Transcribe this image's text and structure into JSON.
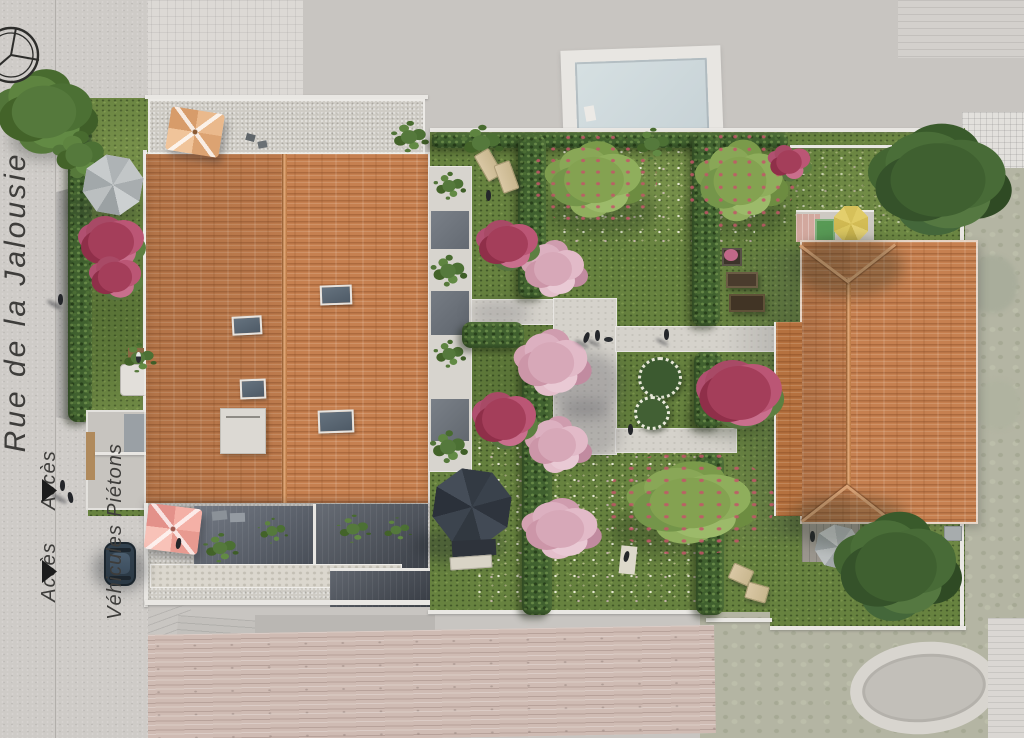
{
  "street": {
    "name": "Rue de la Jalousie",
    "access": [
      {
        "type": "pedestrian",
        "label_line1": "Accès",
        "label_line2": "Piétons",
        "arrow_icon": "right-triangle-arrow"
      },
      {
        "type": "vehicle",
        "label_line1": "Accès",
        "label_line2": "Véhicules",
        "arrow_icon": "right-triangle-arrow"
      }
    ]
  },
  "icons": {
    "compass": "compass-rose-icon"
  },
  "palette": {
    "surroundings_desaturated": "#c8c5c1",
    "street_gray": "#cecbc7",
    "lawn_green": "#67823f",
    "path_gray": "#d5d2cb",
    "hedge_green": "#40602f",
    "roof_terracotta": "#c68050",
    "roof_ridge": "#e2aa7a",
    "cherry_blossom_pink": "#d7a8b8",
    "flower_shrub_red": "#a43e5a",
    "rooftop_parasol_tan": "#eab98c",
    "courtyard_parasol_pink": "#f4b0a6",
    "terrace_parasol_yellow": "#d9c45e",
    "garden_parasol_gray": "#b9bdbf",
    "gazebo_charcoal": "#343b44",
    "neighbor_pool_blue": "#cfdadd",
    "skylight_gray": "#5b6874",
    "label_text": "#3e3d3b",
    "arrow_black": "#1c1c1c"
  }
}
